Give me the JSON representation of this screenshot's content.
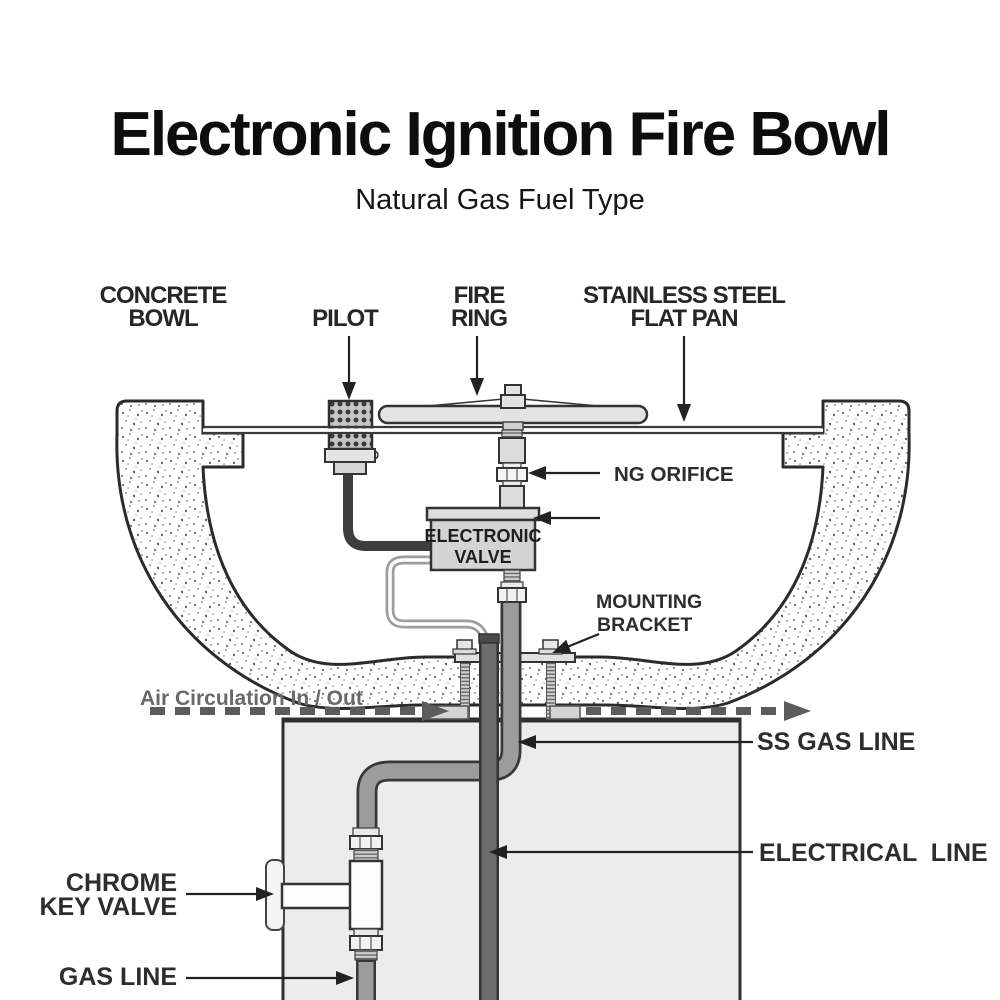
{
  "title": "Electronic Ignition Fire Bowl",
  "subtitle": "Natural Gas Fuel Type",
  "diagram": {
    "labels": {
      "concrete_bowl_line1": "CONCRETE",
      "concrete_bowl_line2": "BOWL",
      "pilot": "PILOT",
      "fire_ring_line1": "FIRE",
      "fire_ring_line2": "RING",
      "flat_pan_line1": "STAINLESS STEEL",
      "flat_pan_line2": "FLAT PAN",
      "ng_orifice": "NG ORIFICE",
      "electronic_valve_line1": "ELECTRONIC",
      "electronic_valve_line2": "VALVE",
      "mounting_bracket_line1": "MOUNTING",
      "mounting_bracket_line2": "BRACKET",
      "air_circulation": "Air Circulation In / Out",
      "ss_gas_line": "SS GAS LINE",
      "electrical_line": "ELECTRICAL  LINE",
      "chrome_key_valve_line1": "CHROME",
      "chrome_key_valve_line2": "KEY VALVE",
      "gas_line": "GAS LINE"
    },
    "colors": {
      "outline_dark": "#2f2f2f",
      "label_dark": "#2d2d2d",
      "air_label_gray": "#696969",
      "dashed_line_gray": "#5c5c5c",
      "ss_pipe_gray": "#9c9c9c",
      "conduit_gray": "#6d6d6d",
      "cable_dark": "#3e3e3e",
      "component_light_gray": "#d6d6d6",
      "pedestal_fill": "#ececec",
      "background": "#ffffff"
    }
  }
}
